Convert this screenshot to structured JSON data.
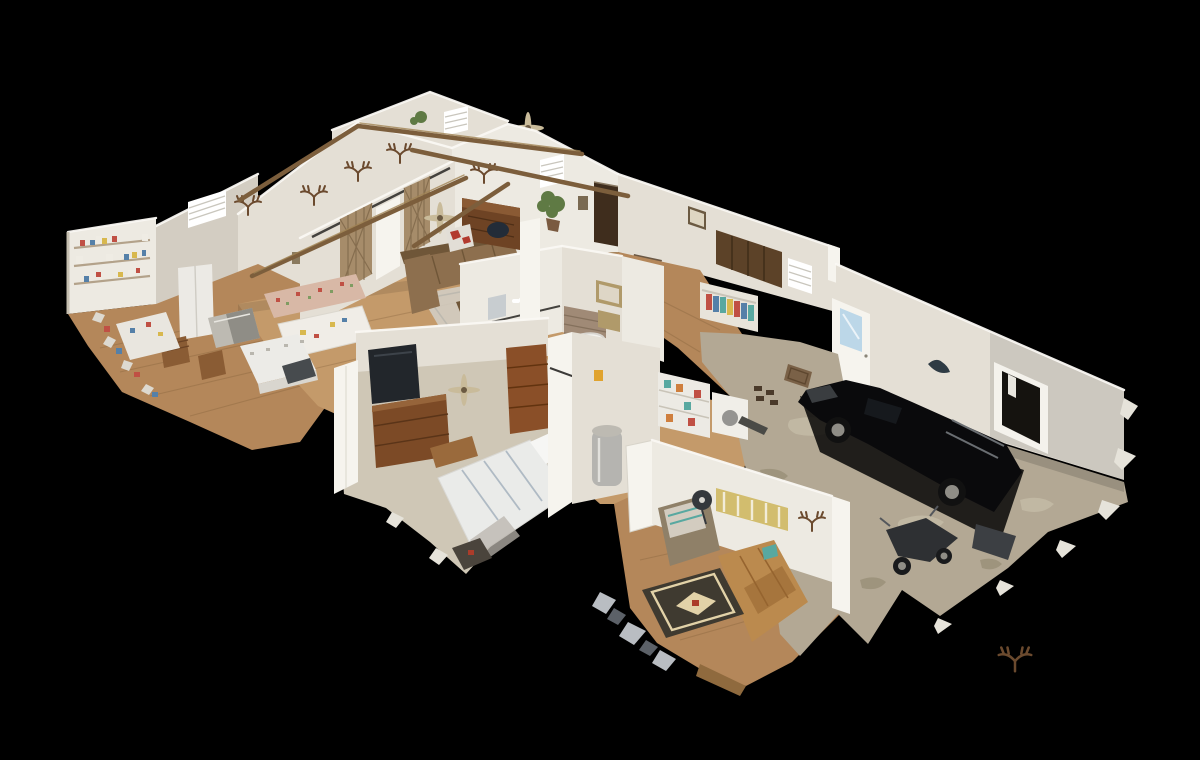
{
  "canvas": {
    "width": 1200,
    "height": 760,
    "background": "#000000"
  },
  "scene": {
    "type": "3d-dollhouse-cutaway-view",
    "source_style": "photogrammetry textured mesh scan",
    "camera": "oblique top-down; house runs diagonally from lower-left to upper-right on a black void",
    "rooms": [
      {
        "name": "craft-pantry-room",
        "items": [
          "wall-shelves-with-supplies",
          "white-work-table",
          "wood-chair",
          "wood-floor"
        ]
      },
      {
        "name": "dining-area",
        "items": [
          "floral-upholstered-chairs",
          "cloth-covered-table",
          "window-with-blinds",
          "wood-chairs",
          "stainless-vent-piece"
        ]
      },
      {
        "name": "kitchen",
        "items": [
          "refrigerator",
          "kitchen-island",
          "dishwasher",
          "dark-wood-upper-cabinets",
          "window-with-blinds"
        ]
      },
      {
        "name": "great-room",
        "items": [
          "exposed-wood-beams",
          "gable-walls",
          "brown-sectional-sofa",
          "roll-top-desk",
          "office-chair",
          "potted-plant",
          "ceiling-fans",
          "area-rug",
          "deer-antler-mounts",
          "double-barn-doors",
          "white-column"
        ]
      },
      {
        "name": "entry",
        "items": [
          "dark-front-door",
          "window-with-blinds",
          "doormat",
          "framed-pictures"
        ]
      },
      {
        "name": "bathroom",
        "items": [
          "bathtub",
          "vanity-lights",
          "mirror",
          "wood-plank-accent-wall",
          "framed-art",
          "barn-door-rail"
        ]
      },
      {
        "name": "closet",
        "items": [
          "hanging-clothes",
          "storage-shelves"
        ]
      },
      {
        "name": "master-bedroom",
        "items": [
          "bed-white-gray-bedding",
          "wood-dresser-with-tv",
          "tall-wood-chest",
          "ceiling-fan",
          "carpet-floor",
          "foot-bench",
          "small-dark-rug",
          "barn-door-rail"
        ]
      },
      {
        "name": "utility-room",
        "items": [
          "water-heater",
          "open-white-door"
        ]
      },
      {
        "name": "laundry-mudroom",
        "items": [
          "washer",
          "storage-shelf-with-clutter",
          "shoes-by-door",
          "doormat"
        ]
      },
      {
        "name": "den",
        "items": [
          "tan-leather-sofa",
          "recliner-with-blanket",
          "pedestal-fan",
          "southwestern-rug",
          "birch-panorama-art",
          "antler-mount"
        ]
      },
      {
        "name": "garage",
        "items": [
          "black-pickup-truck",
          "motorcycles",
          "concrete-floor",
          "exterior-door-with-window",
          "window-opening-in-far-wall",
          "antlers-on-floor",
          "dark-scan-shadows"
        ]
      }
    ],
    "artifacts": [
      "ragged-mesh-edges",
      "black-void-background",
      "scan-shadow-blobs",
      "torn-floor-holes"
    ]
  },
  "palette": {
    "bg": "#000000",
    "wall": "#e4dfd5",
    "wallLight": "#edeae2",
    "wallBright": "#f6f4ee",
    "wallShade": "#d3cdc2",
    "wallTop": "#faf8f3",
    "wood": "#b4875a",
    "woodLight": "#c49a6a",
    "woodDark": "#8f6a3e",
    "plank": "#7a5a34",
    "carpet": "#cfc7b6",
    "concrete": "#b3a894",
    "concreteLight": "#c4bba6",
    "concreteDark": "#968b73",
    "beam": "#7c5e3c",
    "beamLight": "#a08354",
    "barnwood": "#a68c6a",
    "barnwoodDark": "#7e6648",
    "couch": "#8d6f4e",
    "couchDark": "#6f5638",
    "leather": "#bb8a4e",
    "recliner": "#8f8068",
    "blanket": "#d3ccc0",
    "bedWhite": "#eaebe9",
    "bedStripe": "#a4b2bd",
    "dresser": "#7c4a26",
    "chest": "#8a4f28",
    "tv": "#22262b",
    "truck": "#0a0a0c",
    "metal": "#bdbab2",
    "rim": "#8f8d86",
    "rugBase": "#3f3a30",
    "rugCream": "#e2d2a8",
    "rugRed": "#ab3c2a",
    "plant": "#5f7a44",
    "doorDark": "#3f2d1d",
    "sky": "#bcd7e8",
    "artGold": "#d2bd6e",
    "antler": "#6b4a2e",
    "shadow": "#000000",
    "clRed": "#c05044",
    "clBlue": "#5580a8",
    "clYellow": "#d8b84e",
    "clGreen": "#7f9c62",
    "clTeal": "#58a8a0",
    "clOrange": "#cf7f3e"
  }
}
